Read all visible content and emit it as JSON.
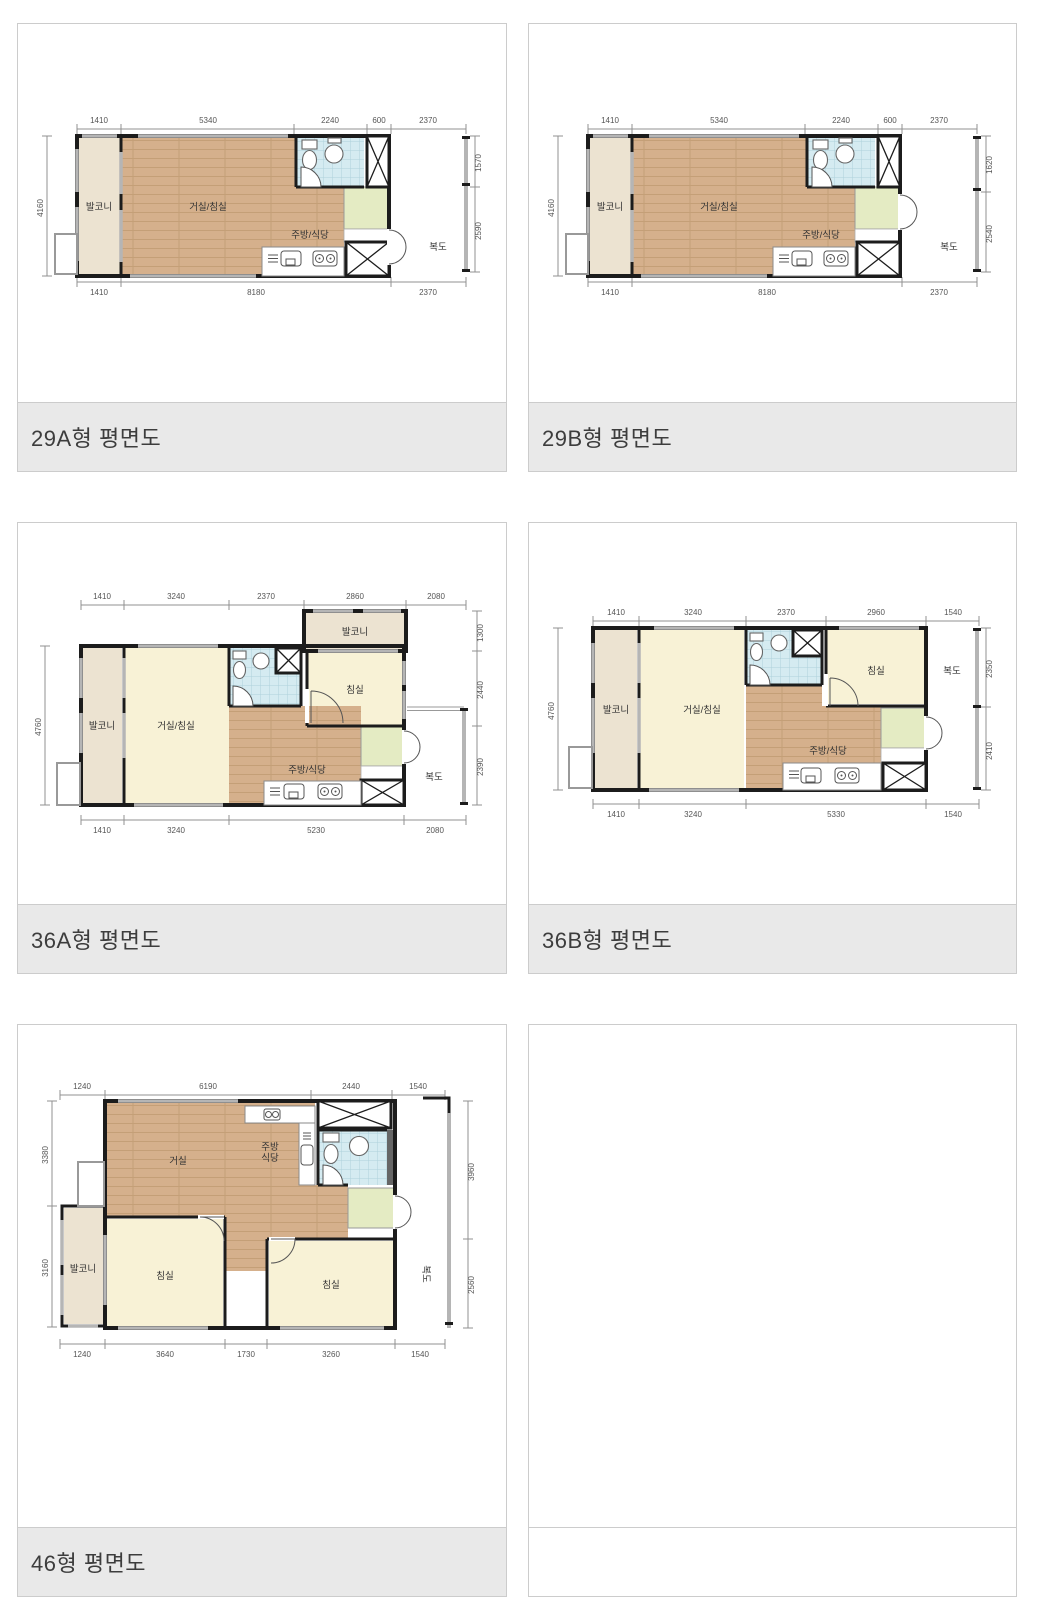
{
  "captions": {
    "a29": "29A형 평면도",
    "b29": "29B형 평면도",
    "a36": "36A형 평면도",
    "b36": "36B형 평면도",
    "p46": "46형 평면도"
  },
  "rooms": {
    "balcony": "발코니",
    "living_bed": "거실/침실",
    "living": "거실",
    "bedroom": "침실",
    "kitchen": "주방/식당",
    "kitchen_l1": "주방",
    "kitchen_l2": "식당",
    "corridor": "복도"
  },
  "p29a": {
    "top": [
      "1410",
      "5340",
      "2240",
      "600",
      "2370"
    ],
    "bottom": [
      "1410",
      "8180",
      "2370"
    ],
    "left": [
      "4160"
    ],
    "right": [
      "1570",
      "2590"
    ]
  },
  "p29b": {
    "top": [
      "1410",
      "5340",
      "2240",
      "600",
      "2370"
    ],
    "bottom": [
      "1410",
      "8180",
      "2370"
    ],
    "left": [
      "4160"
    ],
    "right": [
      "1620",
      "2540"
    ]
  },
  "p36a": {
    "top": [
      "1410",
      "3240",
      "2370",
      "2860",
      "2080"
    ],
    "bottom": [
      "1410",
      "3240",
      "5230",
      "2080"
    ],
    "left": [
      "4760"
    ],
    "right": [
      "1300",
      "2440",
      "2390"
    ]
  },
  "p36b": {
    "top": [
      "1410",
      "3240",
      "2370",
      "2960",
      "1540"
    ],
    "bottom": [
      "1410",
      "3240",
      "5330",
      "1540"
    ],
    "left": [
      "4760"
    ],
    "right": [
      "2350",
      "2410"
    ]
  },
  "p46": {
    "top": [
      "1240",
      "6190",
      "2440",
      "1540"
    ],
    "bottom": [
      "1240",
      "3640",
      "1730",
      "3260",
      "1540"
    ],
    "left": [
      "3380",
      "3160"
    ],
    "right": [
      "3960",
      "2560"
    ]
  },
  "colors": {
    "wall": "#1c1c1c",
    "wood": "#d5b08c",
    "wood_line": "#c49f77",
    "tile": "#d5ebf1",
    "tile_line": "#aed2dc",
    "balcony_cream": "#ece3d1",
    "room_yellow": "#f8f2d6",
    "entry_green": "#e4ebc3",
    "caption_bg": "#e9e9e9",
    "caption_text": "#3d3d3d",
    "cell_border": "#cccccc",
    "dim_gray": "#909090"
  }
}
